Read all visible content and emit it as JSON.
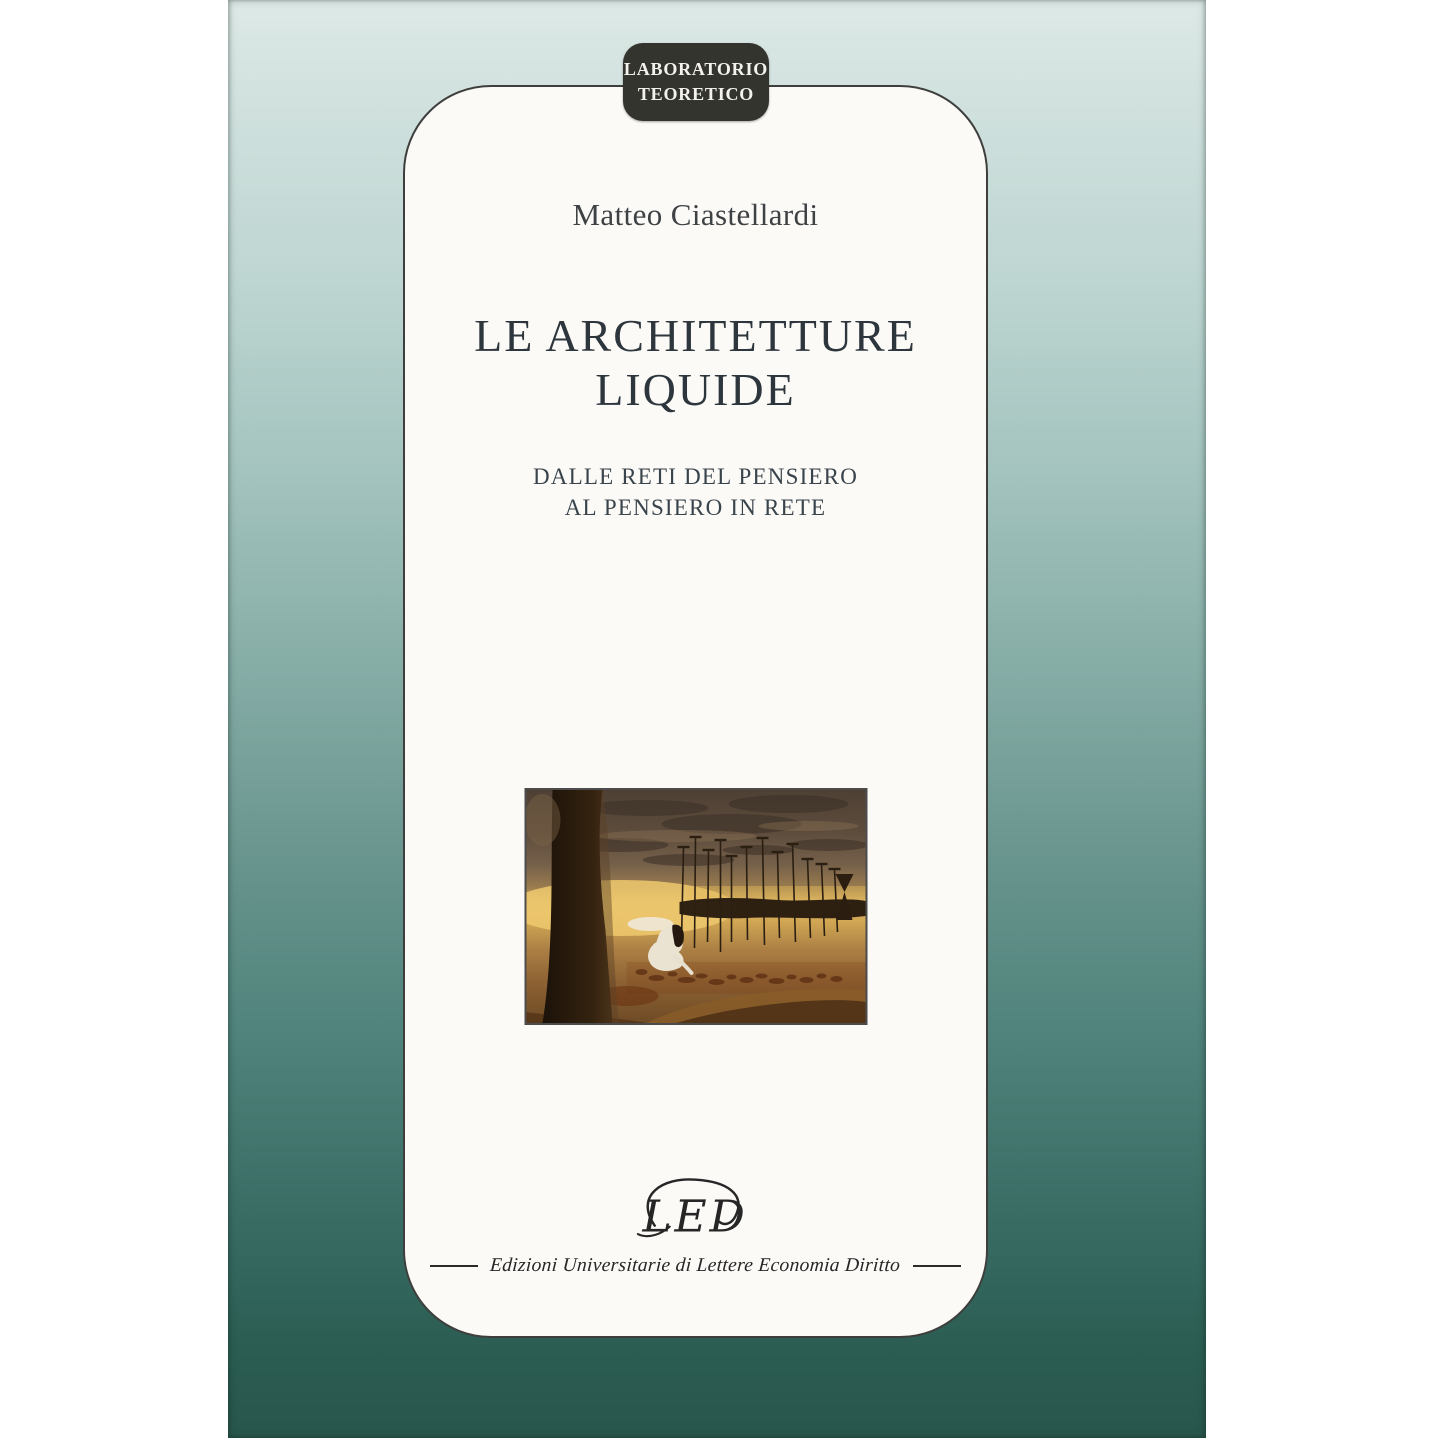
{
  "photo": {
    "background": "#ffffff"
  },
  "cover": {
    "colors": {
      "gradient_top": "#dde9e6",
      "gradient_mid": "#87ada7",
      "gradient_bottom": "#27564c",
      "panel_background": "#fbfaf7",
      "panel_border": "#3e3e3c"
    },
    "badge": {
      "line1": "LABORATORIO",
      "line2": "TEORETICO",
      "background": "#34342f",
      "text_color": "#f4f2ec"
    },
    "author": "Matteo Ciastellardi",
    "title": {
      "line1": "LE ARCHITETTURE",
      "line2": "LIQUIDE",
      "color": "#2d363c"
    },
    "subtitle": {
      "line1": "DALLE RETI DEL PENSIERO",
      "line2": "AL PENSIERO IN RETE",
      "color": "#39434b"
    },
    "artwork": {
      "alt": "surreal painting: crouching white-clad figure beside tall thin poles on golden ground, dark tree trunk at left, dark horizontal reflection band",
      "palette": {
        "sky_dark": "#4e4034",
        "gold_band": "#e9c366",
        "ground": "#a87f42",
        "shadow_band": "#1f140b",
        "trunk": "#241809"
      }
    },
    "publisher": {
      "logo_text": "LED",
      "tagline": "Edizioni Universitarie di Lettere Economia Diritto",
      "color": "#262626"
    }
  }
}
